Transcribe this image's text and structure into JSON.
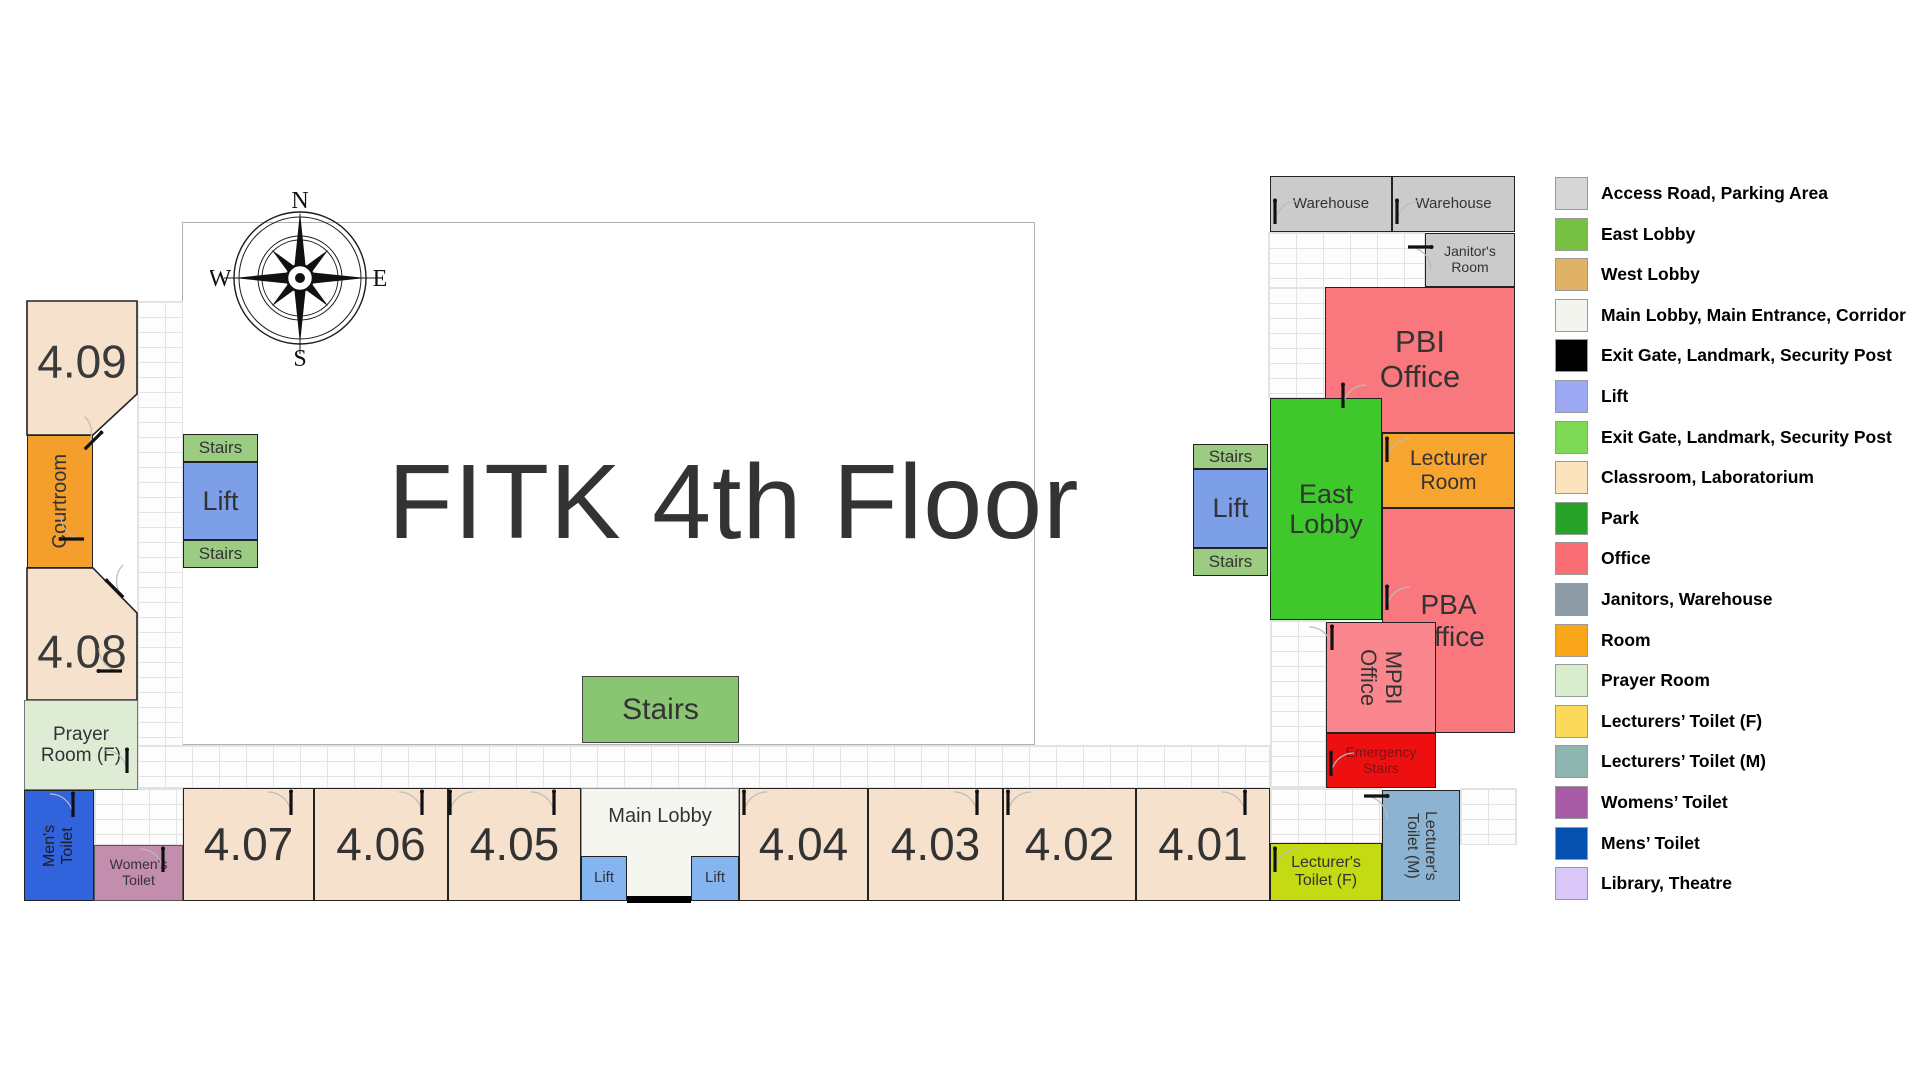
{
  "title": "FITK 4th Floor",
  "compass": {
    "north": "N",
    "east": "E",
    "south": "S",
    "west": "W"
  },
  "colors": {
    "classroom": "#F6E2CC",
    "office": "#F9787E",
    "office_light": "#F9868C",
    "room_orange": "#F49E2C",
    "east_lobby_green": "#3EC82B",
    "park_green": "#8AC573",
    "stairs_sage": "#9CCB82",
    "lift_blue": "#7C9FE8",
    "lobby_lift_blue": "#85B5F0",
    "warehouse_gray": "#CBCBCB",
    "emergency_red": "#EE1010",
    "prayer_green": "#DEECD5",
    "mens_blue": "#3063DC",
    "womens_mauve": "#C38DAD",
    "toiletF_chartreuse": "#C4DA12",
    "toiletM_steel": "#8CB3D1",
    "title_gray": "#333333"
  },
  "map": {
    "areas": [
      {
        "name": "central-area",
        "kind": "plain",
        "x": 182,
        "y": 222,
        "w": 853,
        "h": 523
      },
      {
        "name": "corridor-west",
        "kind": "brick",
        "x": 137,
        "y": 301,
        "w": 46,
        "h": 487
      },
      {
        "name": "corridor-west-lower",
        "kind": "brick",
        "x": 94,
        "y": 788,
        "w": 89,
        "h": 57
      },
      {
        "name": "corridor-south",
        "kind": "brick",
        "x": 137,
        "y": 745,
        "w": 1133,
        "h": 43
      },
      {
        "name": "corridor-east-top",
        "kind": "brick",
        "x": 1268,
        "y": 232,
        "w": 157,
        "h": 56
      },
      {
        "name": "corridor-east-upper",
        "kind": "brick",
        "x": 1268,
        "y": 287,
        "w": 58,
        "h": 111
      },
      {
        "name": "corridor-east-mid",
        "kind": "brick",
        "x": 1270,
        "y": 620,
        "w": 56,
        "h": 168
      },
      {
        "name": "corridor-east-toilet-f",
        "kind": "brick",
        "x": 1270,
        "y": 788,
        "w": 112,
        "h": 55
      },
      {
        "name": "corridor-east-toilet-m",
        "kind": "brick",
        "x": 1460,
        "y": 788,
        "w": 57,
        "h": 57
      }
    ],
    "polygon_rooms": [
      {
        "name": "room-4-09",
        "label": "4.09",
        "points": "27,301 137,301 137,394 93,435 27,435",
        "fill": "#F6E2CC",
        "lx": 27,
        "ly": 318,
        "lw": 110,
        "lh": 86,
        "fs": 46
      },
      {
        "name": "room-4-08",
        "label": "4.08",
        "points": "27,568 93,568 137,613 137,700 27,700",
        "fill": "#F6E2CC",
        "lx": 27,
        "ly": 608,
        "lw": 110,
        "lh": 86,
        "fs": 46
      }
    ],
    "rooms": [
      {
        "name": "courtroom",
        "label": "Courtroom",
        "x": 27,
        "y": 435,
        "w": 66,
        "h": 133,
        "bg": "#F49E2C",
        "fs": 20,
        "rot": -90
      },
      {
        "name": "prayer-room-f",
        "label": "Prayer\nRoom (F)",
        "x": 24,
        "y": 700,
        "w": 114,
        "h": 90,
        "bg": "#DEECD5",
        "fs": 19,
        "border": "1px solid #777"
      },
      {
        "name": "mens-toilet",
        "label": "Men's\nToilet",
        "x": 24,
        "y": 790,
        "w": 70,
        "h": 111,
        "bg": "#3063DC",
        "fs": 16,
        "rot": -90,
        "color": "#1d1d1d"
      },
      {
        "name": "womens-toilet",
        "label": "Women's\nToilet",
        "x": 94,
        "y": 845,
        "w": 89,
        "h": 56,
        "bg": "#C38DAD",
        "fs": 14,
        "border": "1px solid #555"
      },
      {
        "name": "room-4-07",
        "label": "4.07",
        "x": 183,
        "y": 788,
        "w": 131,
        "h": 113,
        "bg": "#F6E2CC",
        "fs": 46
      },
      {
        "name": "room-4-06",
        "label": "4.06",
        "x": 314,
        "y": 788,
        "w": 134,
        "h": 113,
        "bg": "#F6E2CC",
        "fs": 46
      },
      {
        "name": "room-4-05",
        "label": "4.05",
        "x": 448,
        "y": 788,
        "w": 133,
        "h": 113,
        "bg": "#F6E2CC",
        "fs": 46
      },
      {
        "name": "main-lobby",
        "label": "Main Lobby",
        "x": 581,
        "y": 788,
        "w": 158,
        "h": 113,
        "bg": "#F6F6F1",
        "fs": 20,
        "border": "1px solid #999",
        "top": true
      },
      {
        "name": "main-lobby-lift-left",
        "label": "Lift",
        "x": 581,
        "y": 856,
        "w": 46,
        "h": 45,
        "bg": "#85B5F0",
        "fs": 15
      },
      {
        "name": "main-lobby-lift-right",
        "label": "Lift",
        "x": 691,
        "y": 856,
        "w": 48,
        "h": 45,
        "bg": "#85B5F0",
        "fs": 15
      },
      {
        "name": "room-4-04",
        "label": "4.04",
        "x": 739,
        "y": 788,
        "w": 129,
        "h": 113,
        "bg": "#F6E2CC",
        "fs": 46
      },
      {
        "name": "room-4-03",
        "label": "4.03",
        "x": 868,
        "y": 788,
        "w": 135,
        "h": 113,
        "bg": "#F6E2CC",
        "fs": 46
      },
      {
        "name": "room-4-02",
        "label": "4.02",
        "x": 1003,
        "y": 788,
        "w": 133,
        "h": 113,
        "bg": "#F6E2CC",
        "fs": 46
      },
      {
        "name": "room-4-01",
        "label": "4.01",
        "x": 1136,
        "y": 788,
        "w": 134,
        "h": 113,
        "bg": "#F6E2CC",
        "fs": 46
      },
      {
        "name": "stairs-central",
        "label": "Stairs",
        "x": 582,
        "y": 676,
        "w": 157,
        "h": 67,
        "bg": "#8AC573",
        "fs": 30,
        "border": "1.5px solid #444"
      },
      {
        "name": "stairs-west-top",
        "label": "Stairs",
        "x": 183,
        "y": 434,
        "w": 75,
        "h": 28,
        "bg": "#9CCB82",
        "fs": 17
      },
      {
        "name": "lift-west",
        "label": "Lift",
        "x": 183,
        "y": 462,
        "w": 75,
        "h": 78,
        "bg": "#7C9FE8",
        "fs": 27
      },
      {
        "name": "stairs-west-bottom",
        "label": "Stairs",
        "x": 183,
        "y": 540,
        "w": 75,
        "h": 28,
        "bg": "#9CCB82",
        "fs": 17
      },
      {
        "name": "stairs-east-top",
        "label": "Stairs",
        "x": 1193,
        "y": 444,
        "w": 75,
        "h": 25,
        "bg": "#9CCB82",
        "fs": 17
      },
      {
        "name": "lift-east",
        "label": "Lift",
        "x": 1193,
        "y": 469,
        "w": 75,
        "h": 79,
        "bg": "#7C9FE8",
        "fs": 27
      },
      {
        "name": "stairs-east-bottom",
        "label": "Stairs",
        "x": 1193,
        "y": 548,
        "w": 75,
        "h": 28,
        "bg": "#9CCB82",
        "fs": 17
      },
      {
        "name": "warehouse-left",
        "label": "Warehouse",
        "x": 1270,
        "y": 176,
        "w": 122,
        "h": 56,
        "bg": "#CBCBCB",
        "fs": 15
      },
      {
        "name": "warehouse-right",
        "label": "Warehouse",
        "x": 1392,
        "y": 176,
        "w": 123,
        "h": 56,
        "bg": "#CBCBCB",
        "fs": 15
      },
      {
        "name": "janitors-room",
        "label": "Janitor's\nRoom",
        "x": 1425,
        "y": 233,
        "w": 90,
        "h": 54,
        "bg": "#CBCBCB",
        "fs": 14
      },
      {
        "name": "pbi-office",
        "label": "PBI\nOffice",
        "x": 1325,
        "y": 287,
        "w": 190,
        "h": 146,
        "bg": "#F9787E",
        "fs": 31
      },
      {
        "name": "east-lobby",
        "label": "East\nLobby",
        "x": 1270,
        "y": 398,
        "w": 112,
        "h": 222,
        "bg": "#3EC82B",
        "fs": 27
      },
      {
        "name": "lecturer-room",
        "label": "Lecturer\nRoom",
        "x": 1382,
        "y": 433,
        "w": 133,
        "h": 75,
        "bg": "#F7A52E",
        "fs": 21
      },
      {
        "name": "pba-office",
        "label": "PBA\nOffice",
        "x": 1382,
        "y": 508,
        "w": 133,
        "h": 225,
        "bg": "#F9787E",
        "fs": 28
      },
      {
        "name": "mpbi-office",
        "label": "MPBI\nOffice",
        "x": 1326,
        "y": 622,
        "w": 110,
        "h": 111,
        "bg": "#F9868C",
        "fs": 22,
        "rot": 90
      },
      {
        "name": "emergency-stairs",
        "label": "Emergency\nStairs",
        "x": 1326,
        "y": 733,
        "w": 110,
        "h": 55,
        "bg": "#EE1010",
        "fs": 14,
        "color": "#7E1212"
      },
      {
        "name": "lecturers-toilet-f",
        "label": "Lecturer's\nToilet (F)",
        "x": 1270,
        "y": 843,
        "w": 112,
        "h": 58,
        "bg": "#C4DA12",
        "fs": 16
      },
      {
        "name": "lecturers-toilet-m",
        "label": "Lecturer's\nToilet (M)",
        "x": 1382,
        "y": 790,
        "w": 78,
        "h": 111,
        "bg": "#8CB3D1",
        "fs": 16,
        "rot": 90
      }
    ],
    "doors": [
      {
        "x": 1272,
        "y": 198,
        "r": 0,
        "f": false
      },
      {
        "x": 1394,
        "y": 198,
        "r": 0,
        "f": false
      },
      {
        "x": 1428,
        "y": 244,
        "r": 90,
        "f": false
      },
      {
        "x": 1340,
        "y": 382,
        "r": 0,
        "f": false
      },
      {
        "x": 1384,
        "y": 436,
        "r": 0,
        "f": false
      },
      {
        "x": 1384,
        "y": 584,
        "r": 0,
        "f": false
      },
      {
        "x": 1329,
        "y": 624,
        "r": 0,
        "f": true
      },
      {
        "x": 1328,
        "y": 750,
        "r": 0,
        "f": false
      },
      {
        "x": 1384,
        "y": 793,
        "r": 90,
        "f": false
      },
      {
        "x": 1272,
        "y": 846,
        "r": 0,
        "f": false
      },
      {
        "x": 1242,
        "y": 789,
        "r": 0,
        "f": true
      },
      {
        "x": 1005,
        "y": 789,
        "r": 0,
        "f": false
      },
      {
        "x": 974,
        "y": 789,
        "r": 0,
        "f": true
      },
      {
        "x": 741,
        "y": 789,
        "r": 0,
        "f": false
      },
      {
        "x": 551,
        "y": 789,
        "r": 0,
        "f": true
      },
      {
        "x": 447,
        "y": 789,
        "r": 0,
        "f": false
      },
      {
        "x": 419,
        "y": 789,
        "r": 0,
        "f": true
      },
      {
        "x": 288,
        "y": 789,
        "r": 0,
        "f": true
      },
      {
        "x": 70,
        "y": 791,
        "r": 0,
        "f": true
      },
      {
        "x": 160,
        "y": 846,
        "r": 0,
        "f": true
      },
      {
        "x": 124,
        "y": 747,
        "r": 0,
        "f": true
      },
      {
        "x": 96,
        "y": 668,
        "r": -90,
        "f": false
      },
      {
        "x": 98,
        "y": 430,
        "r": 45,
        "f": true
      },
      {
        "x": 104,
        "y": 578,
        "r": -45,
        "f": false
      },
      {
        "x": 58,
        "y": 536,
        "r": -90,
        "f": false
      }
    ],
    "entrance": {
      "x": 627,
      "y": 896,
      "w": 64,
      "h": 7
    }
  },
  "legend": {
    "items": [
      {
        "label": "Access Road, Parking Area",
        "color": "#D6D6D6"
      },
      {
        "label": "East Lobby",
        "color": "#76C043"
      },
      {
        "label": "West Lobby",
        "color": "#DFB266"
      },
      {
        "label": "Main Lobby, Main Entrance, Corridor",
        "color": "#F4F4EE"
      },
      {
        "label": "Exit Gate, Landmark, Security Post",
        "color": "#000000"
      },
      {
        "label": "Lift",
        "color": "#9DA8F3"
      },
      {
        "label": "Exit Gate, Landmark, Security Post",
        "color": "#7ED957"
      },
      {
        "label": "Classroom, Laboratorium",
        "color": "#FBE3BD"
      },
      {
        "label": "Park",
        "color": "#28A228"
      },
      {
        "label": "Office",
        "color": "#F96D75"
      },
      {
        "label": "Janitors, Warehouse",
        "color": "#8D9BA6"
      },
      {
        "label": "Room",
        "color": "#F9A61A"
      },
      {
        "label": "Prayer Room",
        "color": "#D8ECCE"
      },
      {
        "label": "Lecturers’ Toilet (F)",
        "color": "#FBD95B"
      },
      {
        "label": "Lecturers’ Toilet (M)",
        "color": "#8FB5B1"
      },
      {
        "label": "Womens’ Toilet",
        "color": "#A55CA5"
      },
      {
        "label": "Mens’ Toilet",
        "color": "#0551B0"
      },
      {
        "label": "Library, Theatre",
        "color": "#D9C8F7"
      }
    ]
  }
}
